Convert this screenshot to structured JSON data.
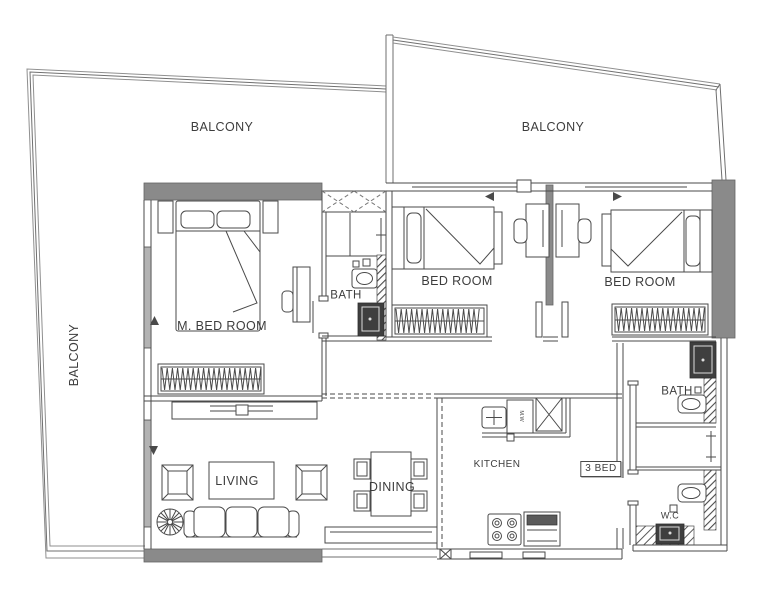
{
  "labels": {
    "balcony_left": "BALCONY",
    "balcony_top_left": "BALCONY",
    "balcony_top_right": "BALCONY",
    "master_bedroom": "M. BED ROOM",
    "bath_master": "BATH",
    "bedroom_2": "BED ROOM",
    "bedroom_3": "BED ROOM",
    "bath_2": "BATH",
    "kitchen": "KITCHEN",
    "dining": "DINING",
    "living": "LIVING",
    "wc": "W.C",
    "unit_badge": "3 BED",
    "microwave": "M.W"
  },
  "colors": {
    "wall_fill": "#8a8a8a",
    "line": "#4a4a4a",
    "dark_fixture": "#3f3f3f",
    "text": "#3d3d3d",
    "background": "#ffffff",
    "window_fill": "#b3b3b3"
  }
}
